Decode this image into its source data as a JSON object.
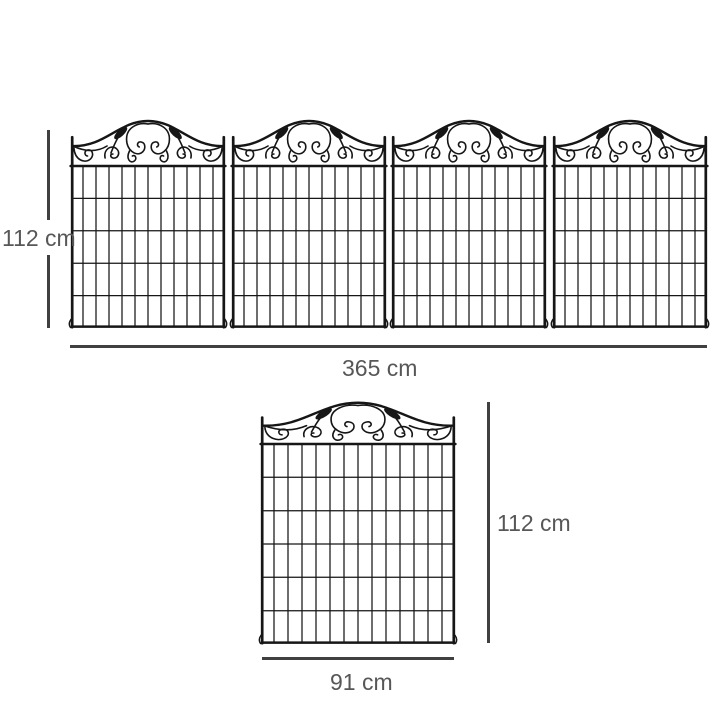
{
  "colors": {
    "background": "#ffffff",
    "fence": "#161616",
    "dimension_line": "#404040",
    "dimension_text": "#575757"
  },
  "fence_row": {
    "panel_count": 4,
    "height_label": "112 cm",
    "width_label": "365 cm"
  },
  "single_panel": {
    "panel_count": 1,
    "height_label": "112 cm",
    "width_label": "91 cm"
  }
}
